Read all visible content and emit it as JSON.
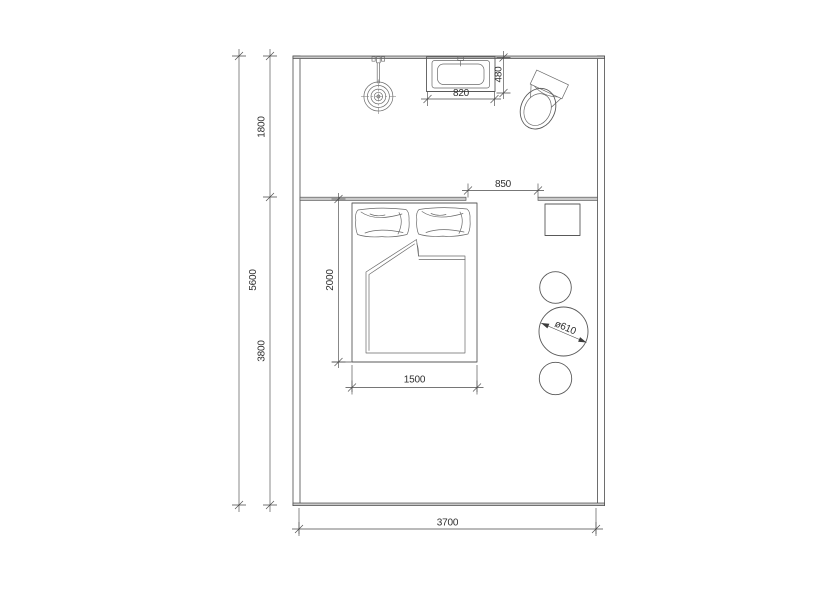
{
  "drawing": {
    "kind": "architectural floor plan — bedroom with en-suite bath zone",
    "colors": {
      "background": "#ffffff",
      "linework": "#4a4a4a",
      "wall_fill": "#c9c9c9",
      "text": "#2f2f2f"
    },
    "dims": {
      "overall_depth": "5600",
      "bath_depth": "1800",
      "bedroom_depth": "3800",
      "room_width": "3700",
      "opening": "850",
      "basin_width": "820",
      "basin_depth": "480",
      "bed_length": "2000",
      "bed_width": "1500",
      "table_diameter": "ø610"
    },
    "fixtures": [
      "shower-head",
      "washbasin",
      "toilet",
      "double-bed",
      "pillows",
      "duvet",
      "nightstand",
      "stool",
      "round-table",
      "stool"
    ]
  }
}
